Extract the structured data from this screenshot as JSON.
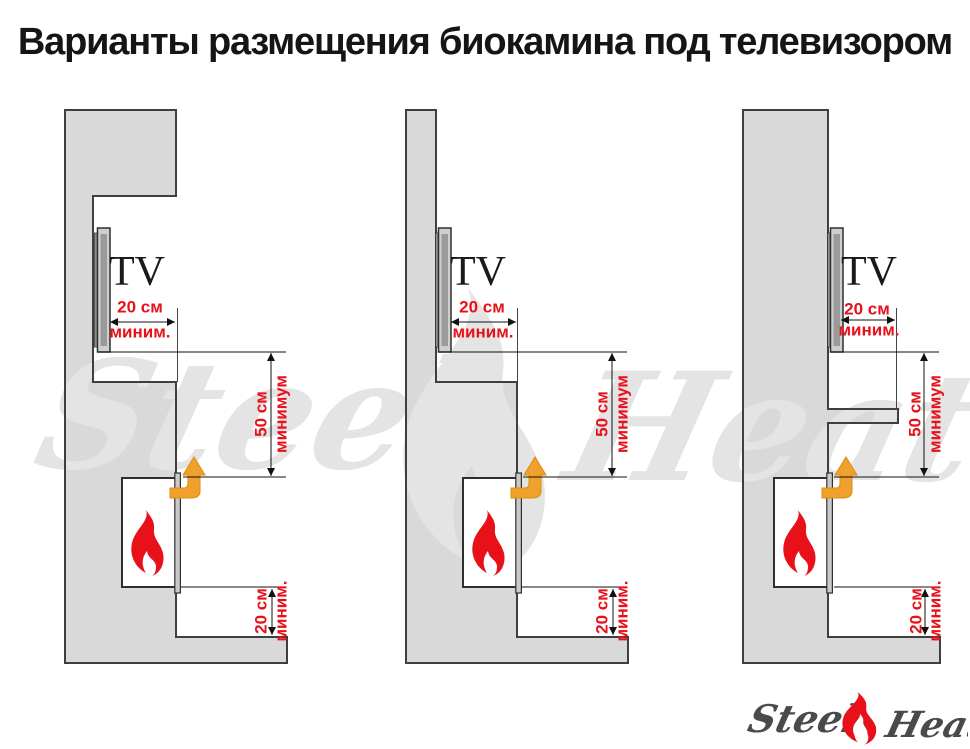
{
  "title": "Варианты размещения биокамина под телевизором",
  "watermark": {
    "word1": "Steel",
    "word2": "Heat"
  },
  "logo": {
    "word1": "Steel",
    "word2": "Heat"
  },
  "colors": {
    "wall_gray": "#d9d9d9",
    "outline_dark": "#3f3f3f",
    "dimension_red": "#e8111a",
    "flame_red": "#e8111a",
    "arrow_orange": "#f0a12c",
    "watermark_gray": "#e4e4e4",
    "logo_text_gray": "#4a4a4a"
  },
  "variants": [
    {
      "tv_label": "TV",
      "top_dim": {
        "value": "20 см",
        "qualifier": "миним."
      },
      "middle_dim": {
        "value": "50 см",
        "qualifier": "минимум"
      },
      "bottom_dim": {
        "value": "20 см",
        "qualifier": "миним."
      }
    },
    {
      "tv_label": "TV",
      "top_dim": {
        "value": "20 см",
        "qualifier": "миним."
      },
      "middle_dim": {
        "value": "50 см",
        "qualifier": "минимум"
      },
      "bottom_dim": {
        "value": "20 см",
        "qualifier": "миним."
      }
    },
    {
      "tv_label": "TV",
      "top_dim": {
        "value": "20 см",
        "qualifier": "миним."
      },
      "middle_dim": {
        "value": "50 см",
        "qualifier": "минимум"
      },
      "bottom_dim": {
        "value": "20 см",
        "qualifier": "миним."
      }
    }
  ]
}
